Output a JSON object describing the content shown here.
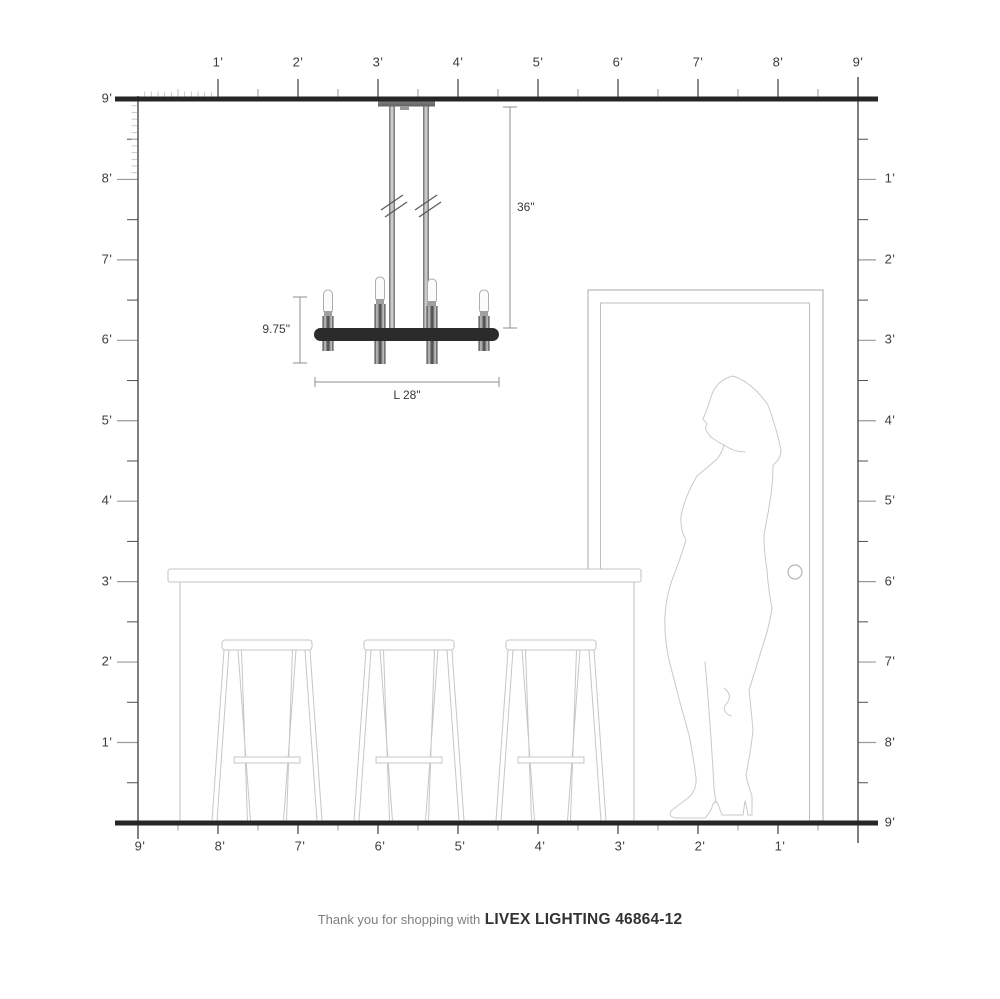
{
  "diagram": {
    "type": "product-scale-illustration",
    "product": {
      "brand": "LIVEX LIGHTING",
      "model": "46864-12",
      "kind": "4-light linear chandelier"
    },
    "dimensions": {
      "drop_label": "36\"",
      "fixture_height_label": "9.75\"",
      "length_label": "L 28\""
    },
    "scene": {
      "room_height_feet": 9,
      "room_width_feet": 9,
      "objects": [
        "chandelier",
        "kitchen-island",
        "bar-stool",
        "bar-stool",
        "bar-stool",
        "door",
        "woman-silhouette"
      ]
    }
  },
  "rulers": {
    "top": {
      "labels": [
        "1'",
        "2'",
        "3'",
        "4'",
        "5'",
        "6'",
        "7'",
        "8'",
        "9'"
      ]
    },
    "left": {
      "labels": [
        "9'",
        "8'",
        "7'",
        "6'",
        "5'",
        "4'",
        "3'",
        "2'",
        "1'"
      ]
    },
    "right": {
      "labels": [
        "1'",
        "2'",
        "3'",
        "4'",
        "5'",
        "6'",
        "7'",
        "8'",
        "9'"
      ]
    },
    "bottom": {
      "labels": [
        "9'",
        "8'",
        "7'",
        "6'",
        "5'",
        "4'",
        "3'",
        "2'",
        "1'"
      ]
    }
  },
  "footer": {
    "thanks": "Thank you for shopping with",
    "brand": "LIVEX LIGHTING 46864-12"
  },
  "colors": {
    "structure_line": "#262626",
    "ruler_line": "#4a4a4a",
    "minor_tick": "#9a9a9a",
    "inch_tick": "#c4c4c4",
    "fixture_bar": "#2b2b2b",
    "metal_gray": "#8c8c8c",
    "furniture_outline": "#c6c6c6",
    "dimension_line": "#8f8f8f"
  }
}
